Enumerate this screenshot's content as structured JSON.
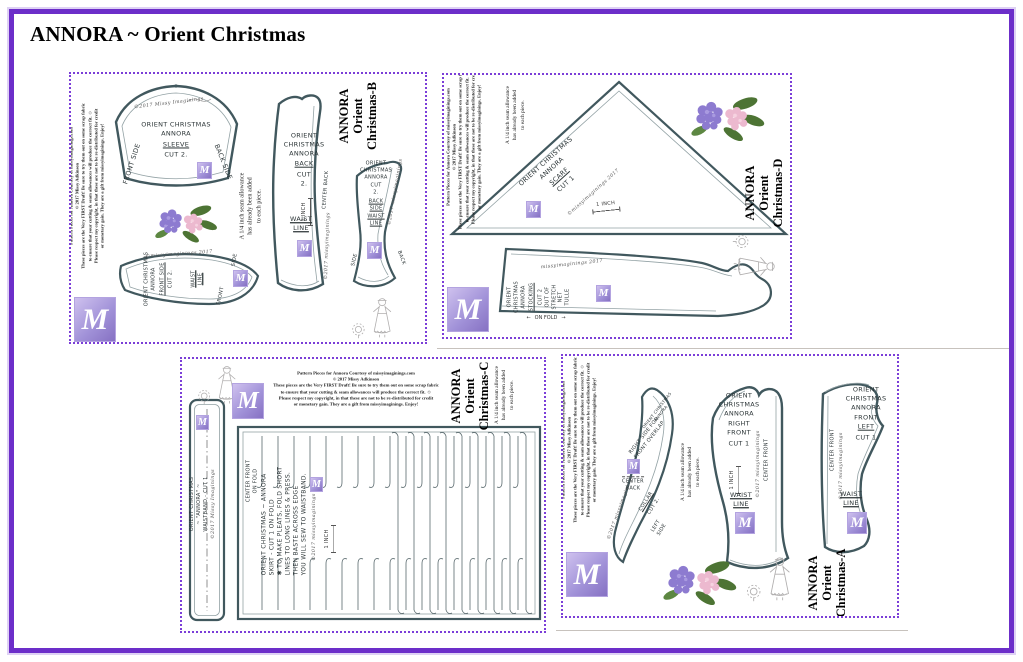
{
  "page": {
    "title": "ANNORA ~ Orient Christmas"
  },
  "logo": {
    "monogram": "M"
  },
  "labels": {
    "inch": "1 INCH",
    "waist": [
      "WAIST",
      "LINE"
    ],
    "center_front": "CENTER FRONT",
    "center_back_line": "CENTER BACK",
    "center_back_lines": [
      "CENTER",
      "BACK"
    ],
    "on_fold": "ON FOLD",
    "side": "SIDE",
    "back": "BACK",
    "front": "FRONT",
    "arrow_left": "←",
    "arrow_right": "→",
    "sig_missy_caps": "©2017 Missy Imaginings",
    "sig_lower": "©2017 missyimaginings",
    "sig_year_last": "©missyimaginings 2017",
    "sig_plain": "missyimaginings 2017"
  },
  "copyright": {
    "lines": [
      "Pattern Pieces for Annora   Courtesy of missyimaginings.com",
      "© 2017 Missy Adkinson",
      "These pieces are the Very FIRST Draft!  Be sure to try them out on some scrap fabric",
      "to ensure that your cutting & seam allowances will produce the correct fit.  ☺",
      "Please respect my copyright, in that these are not to be re-distributed for credit",
      "or monetary gain.  They are a gift from missyimaginings.  Enjoy!"
    ]
  },
  "seam_note": {
    "lines": [
      "A 1/4 inch seam allowance",
      "has already been added",
      "to each piece."
    ]
  },
  "sheet_b": {
    "title_lines": [
      "ANNORA",
      "Orient",
      "Christmas-B"
    ],
    "sleeve": {
      "lines": [
        "ORIENT CHRISTMAS",
        "ANNORA"
      ],
      "name": "SLEEVE",
      "cut": "CUT 2.",
      "left_edge": "FRONT SIDE",
      "right_edge": "BACK SIDE"
    },
    "back": {
      "lines": [
        "ORIENT",
        "CHRISTMAS",
        "ANNORA"
      ],
      "name": "BACK",
      "cut_lines": [
        "CUT",
        "2."
      ]
    },
    "back_side": {
      "lines": [
        "ORIENT",
        "CHRISTMAS",
        "ANNORA"
      ],
      "cut_lines": [
        "CUT",
        "2."
      ],
      "name_lines": [
        "BACK",
        "SIDE"
      ]
    },
    "front_side": {
      "lines": [
        "ORIENT CHRISTMAS",
        "ANNORA"
      ],
      "name": "FRONT SIDE",
      "cut": "CUT 2."
    }
  },
  "sheet_d": {
    "title_lines": [
      "ANNORA",
      "Orient",
      "Christmas-D"
    ],
    "scarf": {
      "lines": [
        "ORIENT CHRISTMAS",
        "ANNORA"
      ],
      "name": "SCARF",
      "cut": "CUT 1"
    },
    "stocking": {
      "lines": [
        "ORIENT",
        "CHRISTMAS",
        "ANNORA"
      ],
      "name": "STOCKING",
      "cut_lines": [
        "CUT 2",
        "OUT OF",
        "STRETCH",
        "NET",
        "TULLE"
      ]
    }
  },
  "sheet_c": {
    "title_lines": [
      "ANNORA",
      "Orient",
      "Christmas-C"
    ],
    "waistband": {
      "lines": [
        "ORIENT CHRISTMAS",
        "~ \"ANNORA\" ~",
        "WAISTBAND - CUT 1"
      ]
    },
    "skirt": {
      "fold_ref": [
        "CENTER FRONT",
        "ON FOLD"
      ],
      "lines": [
        "ORIENT CHRISTMAS ~ ANNORA",
        "SKIRT  - CUT 1 ON FOLD",
        "✱ TO MAKE PLEATS, FOLD SHORT",
        "LINES TO LONG LINES & PRESS.",
        "THEN BASTE ACROSS EDGE",
        "YOU WILL SEW TO WAISTBAND."
      ]
    }
  },
  "sheet_a": {
    "title_lines": [
      "ANNORA",
      "Orient",
      "Christmas-A"
    ],
    "collar": {
      "diag_small": [
        "ORIENT CHRISTMAS",
        "ANNORA"
      ],
      "diag_lines": [
        "RIGHT SIDE FOR",
        "FRONT OVERLAP"
      ],
      "name": "COLLAR",
      "cut": "CUT 2.",
      "left_lines": [
        "LEFT",
        "SIDE"
      ]
    },
    "right_front": {
      "lines": [
        "ORIENT",
        "CHRISTMAS",
        "ANNORA"
      ],
      "name_lines": [
        "RIGHT",
        "FRONT"
      ],
      "cut": "CUT 1"
    },
    "front_left": {
      "lines": [
        "ORIENT",
        "CHRISTMAS",
        "ANNORA"
      ],
      "name_lines": [
        "FRONT",
        "LEFT"
      ],
      "cut": "CUT 1"
    }
  }
}
